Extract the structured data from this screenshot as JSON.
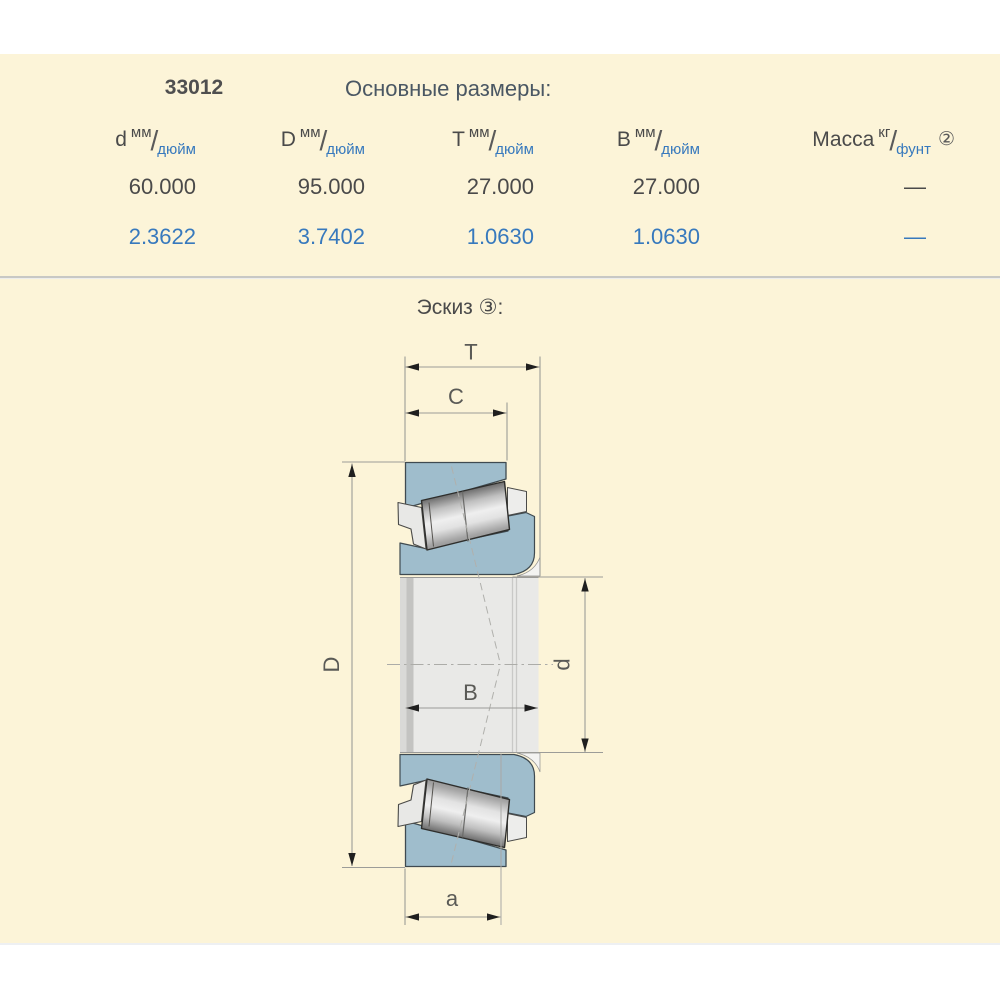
{
  "colors": {
    "sheet_bg": "#FCF4D8",
    "page_bg": "#FFFFFF",
    "text_dark": "#4A4A4A",
    "inch_blue": "#3779BD",
    "bearing_blue": "#9FBDCC",
    "metal_light": "#E9E9E7",
    "separator_gray": "#C8C8C4"
  },
  "table": {
    "part_number": "33012",
    "title": "Основные размеры:",
    "columns": [
      {
        "symbol": "d",
        "unit_top": "мм",
        "slash": "/",
        "unit_bottom": "дюйм"
      },
      {
        "symbol": "D",
        "unit_top": "мм",
        "slash": "/",
        "unit_bottom": "дюйм"
      },
      {
        "symbol": "T",
        "unit_top": "мм",
        "slash": "/",
        "unit_bottom": "дюйм"
      },
      {
        "symbol": "B",
        "unit_top": "мм",
        "slash": "/",
        "unit_bottom": "дюйм"
      },
      {
        "symbol": "Масса",
        "unit_top": "кг",
        "slash": "/",
        "unit_bottom": "фунт",
        "footnote": "②"
      }
    ],
    "row_mm": [
      "60.000",
      "95.000",
      "27.000",
      "27.000",
      "—"
    ],
    "row_inch": [
      "2.3622",
      "3.7402",
      "1.0630",
      "1.0630",
      "—"
    ]
  },
  "sketch": {
    "heading": "Эскиз ③:",
    "dim_labels": {
      "T": "T",
      "C": "C",
      "D": "D",
      "d": "d",
      "B": "B",
      "a": "a"
    }
  }
}
